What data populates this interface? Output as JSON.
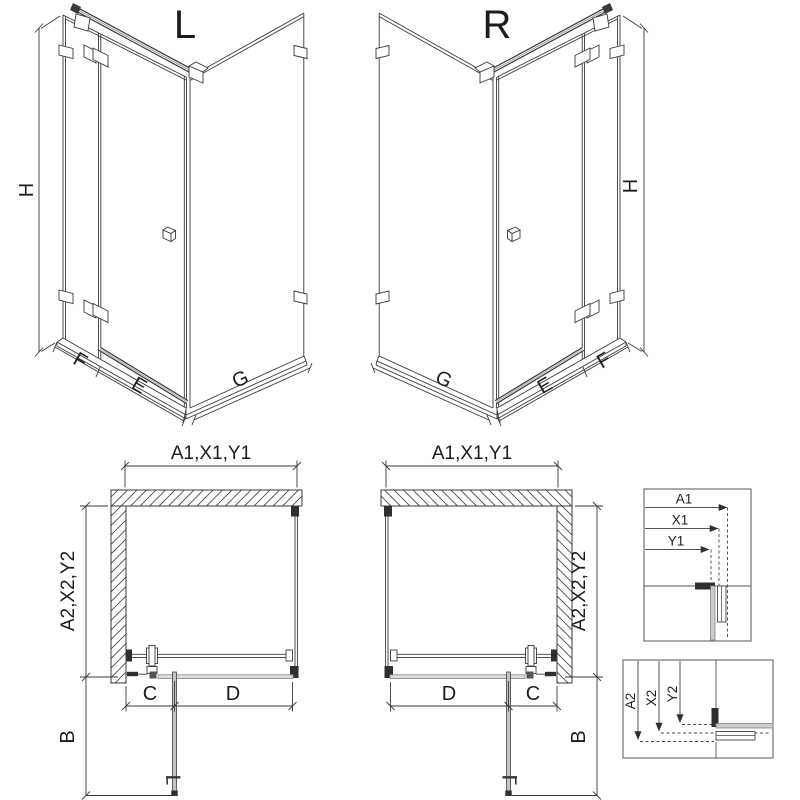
{
  "drawing": {
    "views": {
      "iso_left": {
        "title": "L",
        "dims": {
          "height": "H",
          "fixed": "F",
          "door": "E",
          "side": "G"
        }
      },
      "iso_right": {
        "title": "R",
        "dims": {
          "height": "H",
          "fixed": "F",
          "door": "E",
          "side": "G"
        }
      },
      "plan_left": {
        "dims": {
          "width": "A1,X1,Y1",
          "depth": "A2,X2,Y2",
          "fixed": "C",
          "door": "D",
          "swing": "B"
        }
      },
      "plan_right": {
        "dims": {
          "width": "A1,X1,Y1",
          "depth": "A2,X2,Y2",
          "fixed": "C",
          "door": "D",
          "swing": "B"
        }
      }
    },
    "details": {
      "width_box": {
        "labels": [
          "A1",
          "X1",
          "Y1"
        ]
      },
      "depth_box": {
        "labels": [
          "A2",
          "X2",
          "Y2"
        ]
      }
    },
    "colors": {
      "line": "#3a3a3a",
      "line_gray": "#8a8a8a",
      "fill_dark": "#2f2f2f",
      "glass_gray": "#cccccc",
      "background": "#ffffff"
    }
  }
}
